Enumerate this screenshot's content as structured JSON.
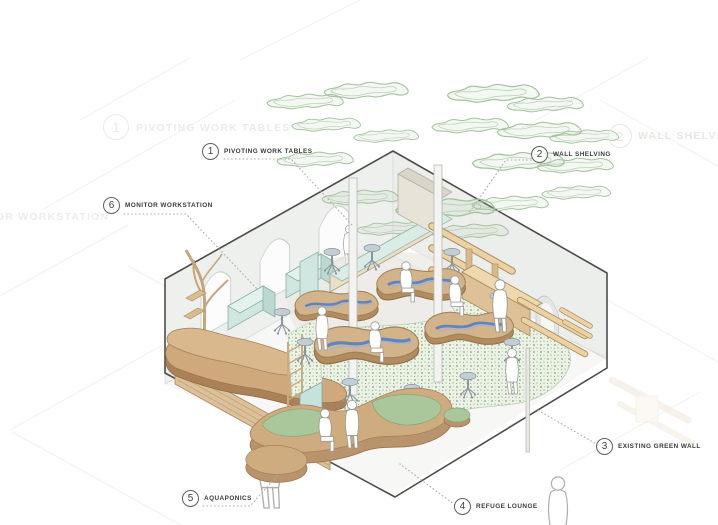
{
  "diagram": {
    "type": "axonometric-interior-cutaway",
    "callouts": [
      {
        "num": "1",
        "label": "PIVOTING WORK TABLES"
      },
      {
        "num": "2",
        "label": "WALL SHELVING"
      },
      {
        "num": "3",
        "label": "EXISTING GREEN WALL"
      },
      {
        "num": "4",
        "label": "REFUGE LOUNGE"
      },
      {
        "num": "5",
        "label": "AQUAPONICS"
      },
      {
        "num": "6",
        "label": "MONITOR WORKSTATION"
      }
    ],
    "ghost_labels": {
      "top_left_num": "1",
      "top_left": "PIVOTING WORK TABLES",
      "top_right_num": "2",
      "top_right": "WALL SHELVING",
      "left": "OR WORKSTATION"
    }
  },
  "colors": {
    "outline": "#4c4c4a",
    "wall_gray": "#eceeec",
    "cloud_green": "#a3c29d",
    "table_wood": "#d3b389",
    "river_blue": "#5f84c2",
    "moss_green": "#96ba8d",
    "lounge_tan": "#cfac7f",
    "cushion_green": "#a9c79a",
    "glass_mint": "#d8ece6",
    "shelf_wood": "#ecd2a2"
  }
}
